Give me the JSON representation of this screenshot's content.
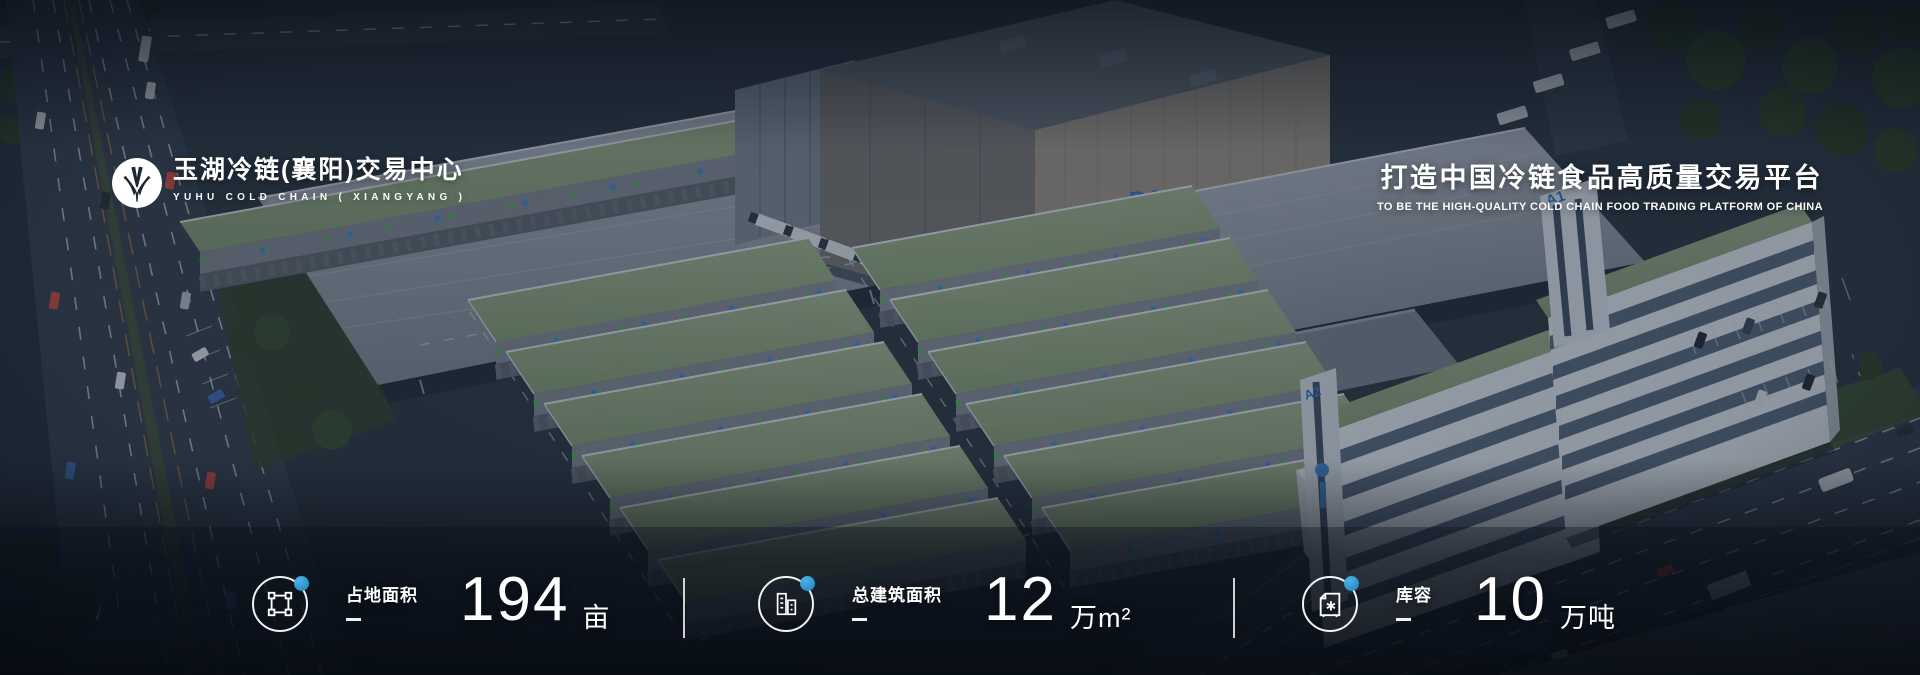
{
  "header": {
    "brand": {
      "name_zh": "玉湖冷链(襄阳)交易中心",
      "name_en": "YUHU COLD CHAIN ( XIANGYANG )"
    },
    "slogan": {
      "zh": "打造中国冷链食品高质量交易平台",
      "en": "TO BE THE HIGH-QUALITY COLD CHAIN FOOD TRADING PLATFORM OF CHINA"
    }
  },
  "stats": {
    "items": [
      {
        "icon": "land-plot-icon",
        "label": "占地面积",
        "value": "194",
        "unit": "亩"
      },
      {
        "icon": "buildings-icon",
        "label": "总建筑面积",
        "value": "12",
        "unit": "万m²"
      },
      {
        "icon": "cold-storage-icon",
        "label": "库容",
        "value": "10",
        "unit": "万吨"
      }
    ]
  },
  "background": {
    "building_labels": {
      "d1": "D1",
      "a1": "A1",
      "a2": "A2",
      "c2": "C2"
    }
  },
  "colors": {
    "accent_blue": "#2f9ad4",
    "building_label_blue": "#2e6fc0",
    "roof_green": "#8ba37b"
  }
}
